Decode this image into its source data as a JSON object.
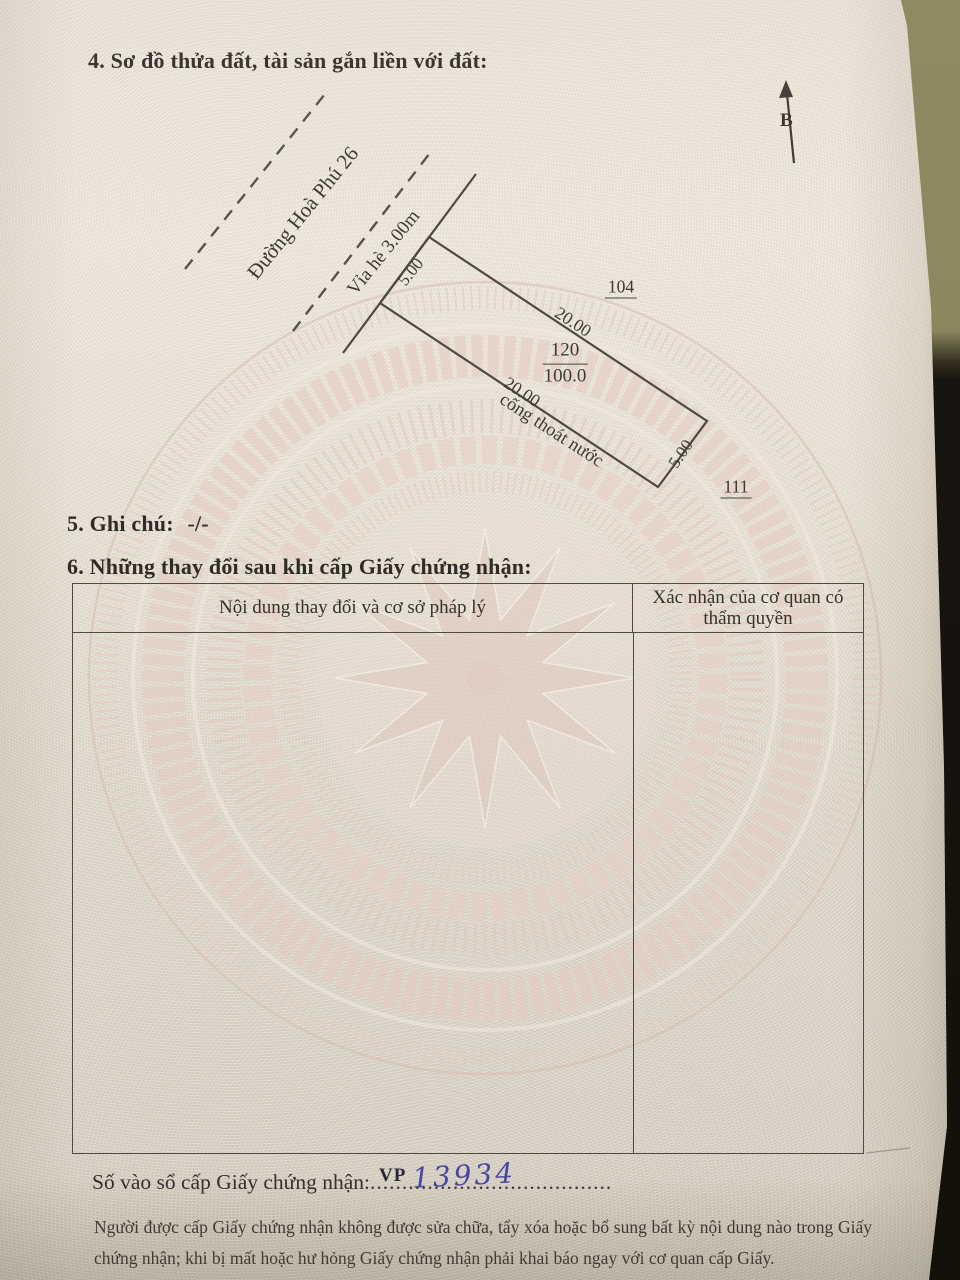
{
  "document": {
    "section4_title": "4. Sơ đồ thửa đất, tài sản gắn liền với đất:",
    "section5_label": "5. Ghi chú:",
    "section5_value": "-/-",
    "section6_title": "6. Những thay đổi sau khi cấp Giấy chứng nhận:",
    "table": {
      "col1_header": "Nội dung thay đổi và cơ sở pháp lý",
      "col2_header": "Xác nhận của cơ quan có thẩm quyền",
      "rows": []
    },
    "registry_line": {
      "label": "Số vào sổ cấp Giấy chứng nhận:",
      "leader_dots": "......................................",
      "office_code": "VP",
      "handwritten_number": "13934"
    },
    "footer_note": "Người được cấp Giấy chứng nhận không được sửa chữa, tẩy xóa hoặc bổ sung bất kỳ nội dung nào trong Giấy chứng nhận; khi bị mất hoặc hư hỏng Giấy chứng nhận phải khai báo ngay với cơ quan cấp Giấy."
  },
  "diagram": {
    "north_label": "B",
    "road_name": "Đường Hoà Phú 26",
    "sidewalk_label": "Vỉa hè 3.00m",
    "frontage_length": "5.00",
    "side_length_right": "20.00",
    "side_length_left": "20.00",
    "back_length": "5.00",
    "parcel_number": "120",
    "parcel_area": "100.0",
    "drain_label": "cống thoát nước",
    "adjacent_parcel_top": "104",
    "adjacent_parcel_bottom": "111"
  },
  "colors": {
    "ink": "#33312b",
    "handwriting_ink": "#4a47a3",
    "watermark_pink": "#e3c9c0",
    "paper_cream": "#ece6d8",
    "backdrop_olive": "#8f8a63",
    "backdrop_black": "#161310"
  }
}
